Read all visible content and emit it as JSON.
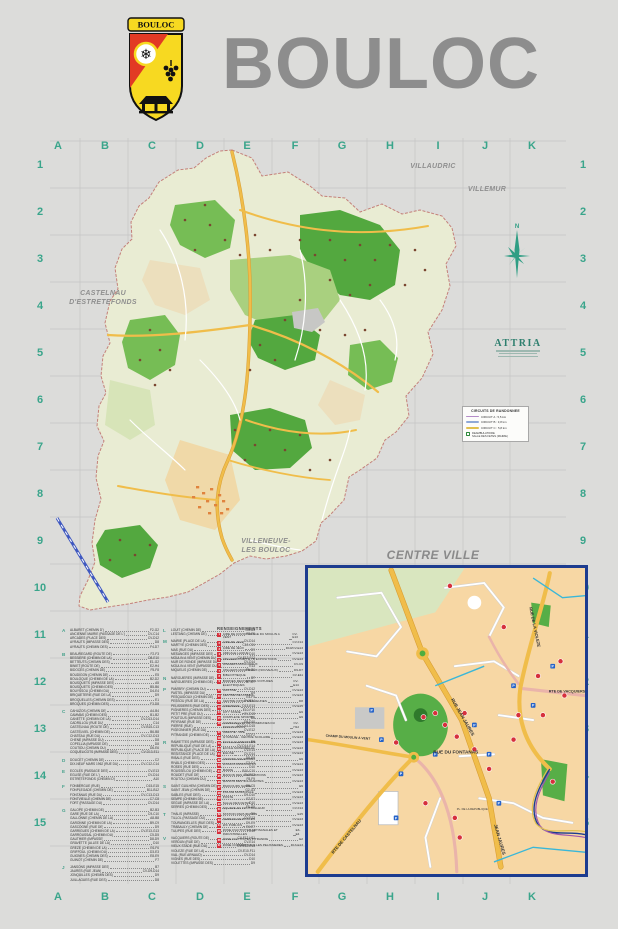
{
  "header": {
    "title": "BOULOC",
    "crest_banner": "BOULOC"
  },
  "colors": {
    "accent_teal": "#3aa58b",
    "title_gray": "#8d8d8d",
    "inset_border": "#1d3c8f",
    "road_yellow": "#f0bd4a",
    "poi_red": "#d6303c",
    "parking_blue": "#2563c9"
  },
  "grid": {
    "cols": [
      "A",
      "B",
      "C",
      "D",
      "E",
      "F",
      "G",
      "H",
      "I",
      "J",
      "K"
    ],
    "rows": [
      "1",
      "2",
      "3",
      "4",
      "5",
      "6",
      "7",
      "8",
      "9",
      "10",
      "11",
      "12",
      "13",
      "14",
      "15"
    ]
  },
  "map": {
    "labels": {
      "villaudric": "VILLAUDRIC",
      "villemur": "VILLEMUR",
      "castelnau_1": "CASTELNAU",
      "castelnau_2": "D'ESTRETEFONDS",
      "villeneuve_1": "VILLENEUVE-",
      "villeneuve_2": "LES BOULOC",
      "compass_n": "N"
    }
  },
  "attria": {
    "name": "ATTRIA"
  },
  "legend": {
    "title": "CIRCUITS DE RANDONNEE",
    "items": [
      {
        "label": "CIRCUIT A : 5,5 km",
        "color": "#b48cc8"
      },
      {
        "label": "CIRCUIT B : 3,8 km",
        "color": "#8fa9d8"
      },
      {
        "label": "CIRCUIT C : 5,8 km",
        "color": "#e0c050"
      }
    ],
    "extra_line1": "DEAMBULATOIRE",
    "extra_line2": "SALLE DES FETES (MAIRIE)"
  },
  "inset": {
    "title": "CENTRE VILLE",
    "streets": [
      "RUE JEAN JAURES",
      "RUE DU FONTANAS",
      "RTE DE CASTELNAU",
      "RTE DE VACQUIERS",
      "RUE DE LA VIOLEZE",
      "CHAMP DU MOULIN A VENT",
      "PL. DE LA REPUBLIQUE",
      "JEAN JAURES"
    ]
  },
  "index": {
    "poi_title": "RENSEIGNEMENTS",
    "col1": [
      {
        "letter": "A",
        "entries": [
          [
            "ALBARET (CHEMIN D')",
            "F2-G2"
          ],
          [
            "ANCIENNE MAIRIE (PASSAGE DE L')",
            "CV-C14"
          ],
          [
            "ARCADES (PLACE DES)",
            "CV-D12"
          ],
          [
            "AYRAUTS (IMPASSE DES)",
            "D8"
          ],
          [
            "AYRAUTS (CHEMIN DES)",
            "F4-D7"
          ]
        ]
      },
      {
        "letter": "B",
        "entries": [
          [
            "BEAUREGARD (ROUTE DE)",
            "F2-F3"
          ],
          [
            "BESSIERE (CHEMIN DE LA)",
            "D8-E10"
          ],
          [
            "BETTEUTS (CHEMIN DES)",
            "E1-G2"
          ],
          [
            "BINIET (ROUTE DE)",
            "E2-H4"
          ],
          [
            "BIDOCES (CHEMIN DE)",
            "F5-F8"
          ],
          [
            "BOUDIGON (CHEMIN DE)",
            "E5"
          ],
          [
            "BOULOQUE (CHEMIN DE LA)",
            "B2-D2"
          ],
          [
            "BOUSQUETS (IMPASSE DES)",
            "A5"
          ],
          [
            "BOUSQUETS (CHEMIN DES)",
            "B5-B6"
          ],
          [
            "BOUYSSOU (CHEMIN DU)",
            "D4-E4"
          ],
          [
            "BRIQUETERIE (RUE DE LA)",
            "D9"
          ],
          [
            "BROQUELLES (CHEMIN DES)",
            "E1"
          ],
          [
            "BROQUES (CHEMIN DES)",
            "F3-D8"
          ]
        ]
      },
      {
        "letter": "C",
        "entries": [
          [
            "CAHUZOS (CHEMIN DE)",
            "A4-B4"
          ],
          [
            "CAMMAS (CHEMIN DES)",
            "B1-B2"
          ],
          [
            "CANETTE (CHEMIN DE LA)",
            "CV-D13-D14"
          ],
          [
            "CADRILLOU (RUE DU)",
            "C14"
          ],
          [
            "CASTELNAU (ROUTE DE)",
            "CV-B15-C13"
          ],
          [
            "CASTELVIEL (CHEMIN DE)",
            "B6-B8"
          ],
          [
            "CHATEAU (RUE DU)",
            "CV-C12-D13"
          ],
          [
            "CHENE (IMPASSE DU)",
            "D8"
          ],
          [
            "COPELLIA (IMPASSE DE)",
            "D8"
          ],
          [
            "COUTIOU (CHEMIN DU)",
            "D6-E6"
          ],
          [
            "COQUELICOTS (IMPASSE DES)",
            "CV-D13-E11"
          ]
        ]
      },
      {
        "letter": "D",
        "entries": [
          [
            "DOUCET (CHEMIN DE)",
            "C2"
          ],
          [
            "DIX-NEUF MARS 1962 (RUE DU)",
            "CV-C12-C14"
          ]
        ]
      },
      {
        "letter": "E",
        "entries": [
          [
            "ECOLES (PASSAGE DES)",
            "CV-E13"
          ],
          [
            "EGLISE (RUE DE L')",
            "CV-D14"
          ],
          [
            "ESTRETEFONDS (CHEMIN D')",
            "A10"
          ]
        ]
      },
      {
        "letter": "F",
        "entries": [
          [
            "FONBERGUE (RUE)",
            "D15-E15"
          ],
          [
            "FONPLEGADE (CHEMIN DE)",
            "B11-B12"
          ],
          [
            "FONTANAS (RUE DU)",
            "CV-C13-D13"
          ],
          [
            "FONTVIEILLE (CHEMIN DE)",
            "C7-C8"
          ],
          [
            "FORT (PASSAGE DU)",
            "CV-D14"
          ]
        ]
      },
      {
        "letter": "G",
        "entries": [
          [
            "GALOPE (CHEMIN DE)",
            "B2-B3"
          ],
          [
            "GARE (RUE DE LA)",
            "C9-C10"
          ],
          [
            "GALLONNE (CHEMIN DE LA)",
            "A8-B8"
          ],
          [
            "GARONNE (CHEMIN DE LA)",
            "B9-C9"
          ],
          [
            "GASCOGNE (RUE DE)",
            "D9"
          ],
          [
            "GARRIGUES (CHEMIN DE LA)",
            "CV-E13-G13"
          ],
          [
            "GARROUSSAL (CHEMIN DU)",
            "C5-D5"
          ],
          [
            "GAUTHIER (IMPASSE)",
            "D8-D9"
          ],
          [
            "GRAVETTE (ALLEE DE LA)",
            "D10"
          ],
          [
            "GREZE (CHEMIN DE LA)",
            "E6-F6"
          ],
          [
            "GRIFFOUL (CHEMIN DU)",
            "D3-E3"
          ],
          [
            "GUIGNES (CHEMIN DES)",
            "E8-E9"
          ],
          [
            "GUINOT (CHEMIN DE)",
            "F7"
          ]
        ]
      },
      {
        "letter": "J",
        "entries": [
          [
            "JANSONS (IMPASSE DES)",
            "B7"
          ],
          [
            "JAURES (RUE JEAN)",
            "CV-D9-D14"
          ],
          [
            "JONQUILLES (CHEMIN DES)",
            "D9"
          ],
          [
            "JUILLAGUES (RUE DES)",
            "D8"
          ]
        ]
      }
    ],
    "col2": [
      {
        "letter": "L",
        "entries": [
          [
            "LOUIT (CHEMIN DE)",
            "G4-G5"
          ],
          [
            "LESTANG (CHEMIN DE)",
            "E5-F5"
          ]
        ]
      },
      {
        "letter": "M",
        "entries": [
          [
            "MAIRIE (PLACE DE LA)",
            "CV-D14"
          ],
          [
            "MARTYE (CHEMIN DES)",
            "C10-C11"
          ],
          [
            "MAS (RUE DU)",
            "D9"
          ],
          [
            "MESANGES (IMPASSE DES)",
            "D10"
          ],
          [
            "MOULIN A VENT (CHEMIN DU)",
            "CV-E13-F12"
          ],
          [
            "MUR DE RONDE (IMPASSE DU)",
            "CV-D14"
          ],
          [
            "MOULIN A VENT (IMPASSE DU)",
            "E13"
          ],
          [
            "MIQUELIS (CHEMIN DE)",
            "F6-G6"
          ]
        ]
      },
      {
        "letter": "N",
        "entries": [
          [
            "NARGUIERES (IMPASSE DE)",
            "B7"
          ],
          [
            "NARGUIERES (CHEMIN DE)",
            "B7-C7"
          ]
        ]
      },
      {
        "letter": "P",
        "entries": [
          [
            "PAM'BRY (CHEMIN DU)",
            "CV-D12"
          ],
          [
            "PASTEL (IMPASSE DU)",
            "D9"
          ],
          [
            "PESQUIDOUX (CHEMIN DE)",
            "E4-F4"
          ],
          [
            "PESSOU (RUE DE LA)",
            "CV-E14"
          ],
          [
            "PELISSIERES (RUE DES)",
            "D13-E13"
          ],
          [
            "PIGNIERES (CHEMIN DES)",
            "E10-F10"
          ],
          [
            "PETIT PRE (RUE DU)",
            "CV-D13"
          ],
          [
            "POUTOUS (IMPASSE DES)",
            "D8"
          ],
          [
            "PEYRANE (RUE DE)",
            "D9-D10"
          ],
          [
            "PIERRE (RUE)",
            "CV-D14-D15"
          ],
          [
            "PIGEONNIER (RUE DU)",
            "CV-E12"
          ],
          [
            "PITRANDIE (CHEMIN DE)",
            "E2-F2"
          ]
        ]
      },
      {
        "letter": "R",
        "entries": [
          [
            "RAMIETTES (IMPASSE DES)",
            "D9"
          ],
          [
            "REPUBLIQUE (RUE DE LA)",
            "CV-D14-E14"
          ],
          [
            "REPUBLIQUE (PLACE DE LA)",
            "CV-E14"
          ],
          [
            "RESISTANCE (PLACE DE LA)",
            "CV-D14"
          ],
          [
            "RIBALS (RUE DES)",
            "D8-D9"
          ],
          [
            "RIVALS (CHEMIN DES)",
            "C3-C4"
          ],
          [
            "ROSES (RUE DES)",
            "D10"
          ],
          [
            "ROUSSELOU (CHEMIN DE)",
            "B10-C10"
          ],
          [
            "ROUDET (RUE DE)",
            "CV-E12"
          ],
          [
            "ROUTOU (CHEMIN DU)",
            "F8-F9"
          ]
        ]
      },
      {
        "letter": "S",
        "entries": [
          [
            "SAINT GUILHEM (CHEMIN DE)",
            "B5-C5"
          ],
          [
            "SAINT JEAN (CHEMIN DE)",
            "G2-G3"
          ],
          [
            "SABLES (RUE DES)",
            "D9-D10"
          ],
          [
            "SEMPE (CHEMIN DE)",
            "E7-F7"
          ],
          [
            "SEGUE (IMPASSE DE LA)",
            "D10"
          ],
          [
            "SERRES (CHEMIN DES)",
            "F5-G5"
          ]
        ]
      },
      {
        "letter": "T",
        "entries": [
          [
            "THALIS (IMPASSE)",
            "D9"
          ],
          [
            "TILLOL (PASSAGE DU)",
            "CV-E13"
          ],
          [
            "TOURANGELLES (RUE DES)",
            "D9-E9"
          ],
          [
            "TRABAULY (CHEMIN DE)",
            "E6-E7"
          ],
          [
            "TULIPES (RUE DES)",
            "D10"
          ]
        ]
      },
      {
        "letter": "V",
        "entries": [
          [
            "VACQUIERS (ROUTE DE)",
            "CV-F12-H11"
          ],
          [
            "VERDUN (RUE DE)",
            "CV-E14"
          ],
          [
            "VIEUX STADE (RUE DU)",
            "CV-E12-E13"
          ],
          [
            "VIOLEZE (RUE DE LA)",
            "CV-E10-F11"
          ],
          [
            "VIAL (RUE ARNAUD)",
            "CV-D14"
          ],
          [
            "VIGNES (RUE DES)",
            "D10"
          ],
          [
            "VIOLETTES (IMPASSE DES)",
            "D9"
          ]
        ]
      }
    ],
    "poi": [
      [
        "1",
        "AIRE DE COVOITURAGE DU MOULIN A VENT",
        "CV-E13"
      ],
      [
        "2",
        "AIRE DE JEUX",
        "CV-F14"
      ],
      [
        "3",
        "AIRE DE JEUX",
        "D10/CV-E13"
      ],
      [
        "4",
        "AMICALE LAIQUE",
        "CV-E13"
      ],
      [
        "5",
        "ATELIERS D'ART ET D'EXPOSITIONS",
        "CV-E13"
      ],
      [
        "6",
        "ATELIERS MUNICIPAUX",
        "CV-C9"
      ],
      [
        "7",
        "ATELIERS MUNICIPAUX (NOUVEAUX)",
        "D9-D7"
      ],
      [
        "8",
        "BIBLIOTHEQUE",
        "CV-E11"
      ],
      [
        "9",
        "BORNES RECHARGES VOITURES ELECTRIQUES",
        "CV-E14"
      ],
      [
        "10",
        "CANTINE",
        "CV-E13"
      ],
      [
        "11",
        "CENTRE DE LOISIRS",
        "CV-E13"
      ],
      [
        "12",
        "CENTRE INITIATIVES JEUNES",
        "D8"
      ],
      [
        "13",
        "CIMETIERE",
        "CV-E15"
      ],
      [
        "14",
        "CITY STADE",
        "E9"
      ],
      [
        "15",
        "COMPLEXE SPORTIF",
        "E9"
      ],
      [
        "16",
        "COMMUNAUTE DE COMMUNES DU FRONTONNAIS",
        "CV-H12"
      ],
      [
        "17",
        "CRECHE - RPE",
        "CV-E13"
      ],
      [
        "18",
        "GYMNASE - CENTRE SCOLAIRE",
        "CV-E13"
      ],
      [
        "19",
        "ECOLE ELEMENTAIRE",
        "CV-E13"
      ],
      [
        "20",
        "ECOLE MATERNELLE",
        "CV-E13"
      ],
      [
        "21",
        "EGLISE",
        "CV-E14"
      ],
      [
        "22",
        "JARDINS SOLIDAIRES",
        "E9"
      ],
      [
        "23",
        "LOCAUX ASSOCIATIFS",
        "CV-E14"
      ],
      [
        "24",
        "MAIRIE",
        "CV-E13"
      ],
      [
        "25",
        "MAISON DES ASSOCIATIONS",
        "CV-E13"
      ],
      [
        "26",
        "MAISON DES SOLIDARITES",
        "CV-E13"
      ],
      [
        "27",
        "PARCOURS SANTE",
        "E9"
      ],
      [
        "28",
        "POLICE MUNICIPALE",
        "CV-E13"
      ],
      [
        "29",
        "POSTE",
        "CV-E13"
      ],
      [
        "30",
        "SALLE DES FETES",
        "CV-E13"
      ],
      [
        "31",
        "SQUARE DU FOOTBALLEUR",
        "CV-F14"
      ],
      [
        "32",
        "STATION D'EPURATION",
        "E15"
      ],
      [
        "33",
        "TERRAIN DE BOULES",
        "CV-E13"
      ],
      [
        "34",
        "WC PUBLICS",
        "CV-E13"
      ],
      [
        "35",
        "ZONE D'ACTIVITES ARTISANALES ET INDUSTRIELLES",
        "E3-E4"
      ],
      [
        "36",
        "ZONE D'ACTIVITES PITRANDIE",
        "E2"
      ],
      [
        "37",
        "ZONE COMMERCIALE LES PELISSIERES",
        "D13-E13"
      ]
    ]
  }
}
